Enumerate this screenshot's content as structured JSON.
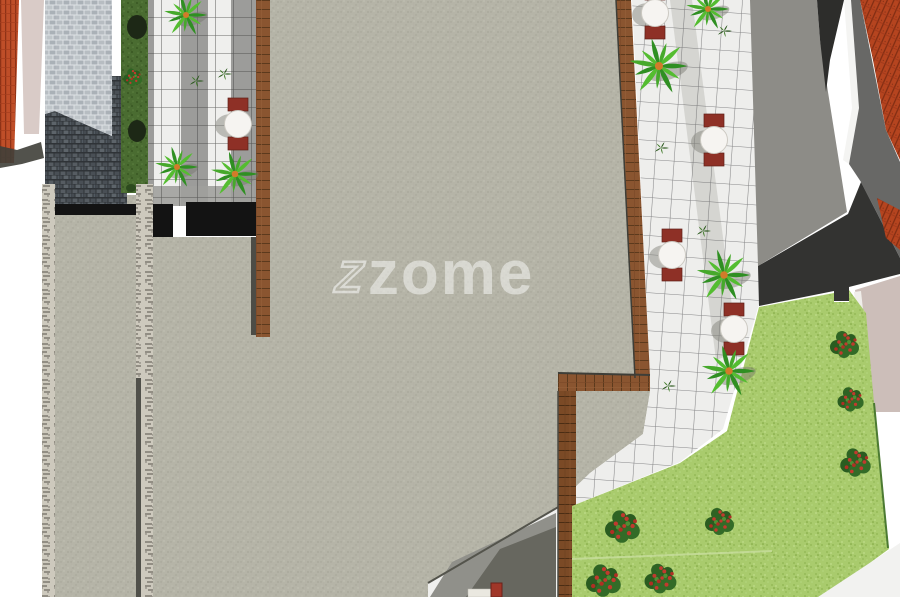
{
  "watermark": {
    "logo_glyph": "Z",
    "wordmark": "zome",
    "opacity": 0.5
  },
  "palette": {
    "gravel": "#b5b4a7",
    "tile_white": "#efefed",
    "tile_grey": "#9c9c9a",
    "grid_line": "#3c3c3a",
    "walkway_white": "#eeeeec",
    "wood_brown": "#8a5530",
    "wood_dark": "#7b4a26",
    "lawn": "#a9cb6d",
    "hedge": "#4a6c31",
    "road": "#8d8c87",
    "charcoal": "#333331",
    "roof_red": "#b5441f",
    "roof_grey": "#686866",
    "cobble_light": "#b7bdc2",
    "cobble_dark": "#40454a",
    "stone_wall": "#cdc9bd",
    "paving_pink": "#ccbeb9",
    "table_white": "#f6f4f1",
    "chair_red": "#8e3026",
    "agave_green": "#3da42c",
    "bush_green": "#2e6323",
    "flower_red": "#c13a2e",
    "shadow_grey": "#90908a",
    "black_wall": "#131313"
  },
  "scene": {
    "tables": [
      {
        "x": 238,
        "y": 124
      },
      {
        "x": 655,
        "y": 13
      },
      {
        "x": 714,
        "y": 140
      },
      {
        "x": 672,
        "y": 255
      },
      {
        "x": 734,
        "y": 329
      }
    ],
    "agaves": [
      {
        "x": 186,
        "y": 15,
        "s": 1.0
      },
      {
        "x": 177,
        "y": 167,
        "s": 1.0
      },
      {
        "x": 235,
        "y": 174,
        "s": 1.1
      },
      {
        "x": 708,
        "y": 9,
        "s": 1.0
      },
      {
        "x": 659,
        "y": 66,
        "s": 1.35
      },
      {
        "x": 724,
        "y": 275,
        "s": 1.25
      },
      {
        "x": 729,
        "y": 371,
        "s": 1.25
      }
    ],
    "sprouts": [
      {
        "x": 196,
        "y": 81
      },
      {
        "x": 224,
        "y": 74
      },
      {
        "x": 724,
        "y": 31
      },
      {
        "x": 661,
        "y": 148
      },
      {
        "x": 703,
        "y": 231
      },
      {
        "x": 668,
        "y": 386
      }
    ],
    "flower_bushes": [
      {
        "x": 133,
        "y": 77,
        "s": 0.65
      },
      {
        "x": 845,
        "y": 344,
        "s": 1.0
      },
      {
        "x": 851,
        "y": 399,
        "s": 0.9
      },
      {
        "x": 856,
        "y": 462,
        "s": 1.05
      },
      {
        "x": 720,
        "y": 521,
        "s": 1.0
      },
      {
        "x": 623,
        "y": 526,
        "s": 1.2
      },
      {
        "x": 604,
        "y": 580,
        "s": 1.2
      },
      {
        "x": 661,
        "y": 578,
        "s": 1.1
      }
    ]
  }
}
